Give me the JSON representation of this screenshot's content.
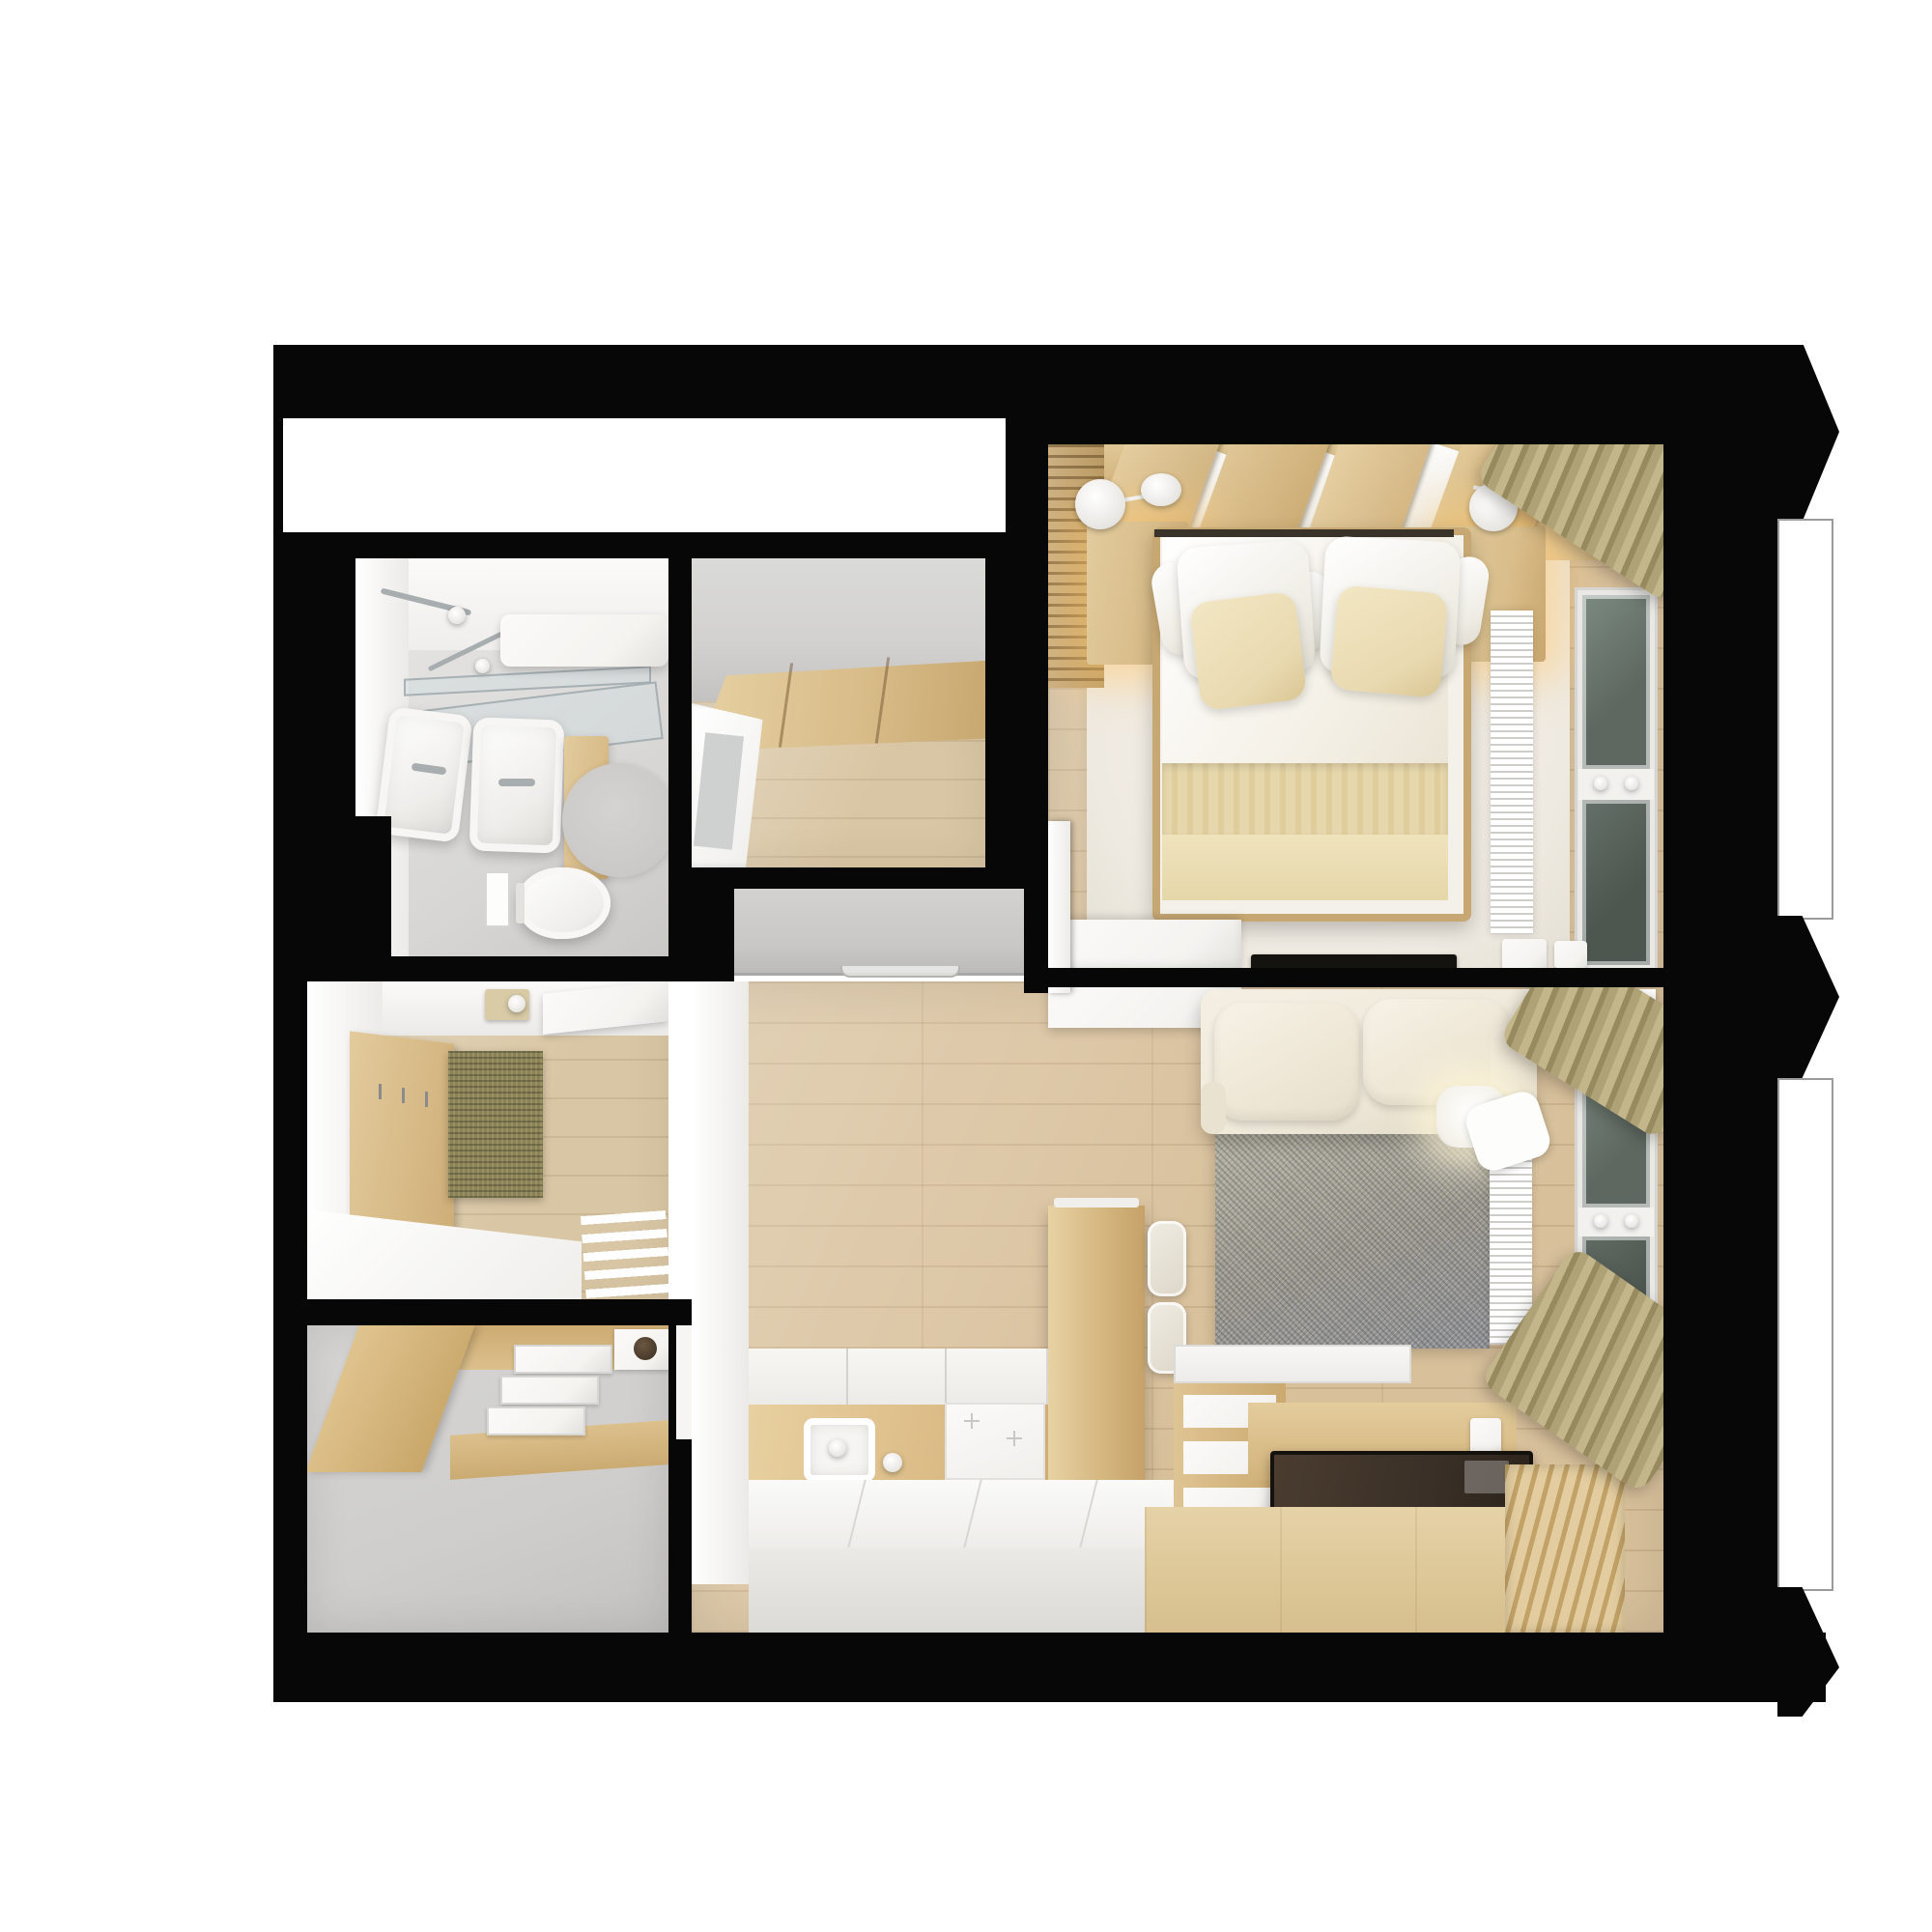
{
  "meta": {
    "title": "Top-down 3D render of a one-bedroom apartment floor plan",
    "view": "orthographic top view, black cut walls on white background",
    "visible_text": "none"
  },
  "palette": {
    "page": "#ffffff",
    "wall": "#070707",
    "floor": "#d8c09b",
    "floor2": "#d9c6a4",
    "panel": "#d9bd8a",
    "panelDark": "#c9a76e",
    "grayWall": "#d2d1cf",
    "grayFloor": "#cfcecc",
    "slab": "#c8c7c5",
    "whiteF": "#f4f3f0",
    "cream": "#efe9da",
    "beige": "#e9d9b0",
    "bedRug": "#efeae1",
    "rugA": "#9b988f",
    "rugB": "#b8b4a6",
    "glassA": "#5e6860",
    "glassB": "#4d574f",
    "frame": "#e9e8e4",
    "curtA": "#c3b68b",
    "curtB": "#978a5f",
    "mat": "#8a8254",
    "darkT": "#3a3027",
    "glow": "rgba(255,198,110,0.55)",
    "chrome": "#a8adb0"
  },
  "rooms": {
    "bathroom": {
      "label": "Bathroom",
      "items": [
        "shower set",
        "glass screen",
        "bathtub",
        "double washbasin",
        "vanity cabinet",
        "round rug",
        "wall-hung toilet",
        "flush plate"
      ]
    },
    "closet": {
      "label": "Walk-in closet",
      "items": [
        "wardrobe front",
        "white glazed door"
      ]
    },
    "bedroom": {
      "label": "Bedroom",
      "items": [
        "double bed",
        "white and beige pillows",
        "two nightstands with lit sconces",
        "slatted accent wall",
        "angled headboard panels",
        "area rug",
        "white dresser",
        "flat TV on wall shelf",
        "radiator grille",
        "window with dark sashes",
        "olive curtain"
      ]
    },
    "hallway": {
      "label": "Hallway",
      "items": [
        "gray wardrobe cabinet",
        "white bedroom door"
      ]
    },
    "entry": {
      "label": "Entry hall",
      "items": [
        "intercom panel",
        "coat panel with hooks",
        "olive doormat",
        "white shelf",
        "white console",
        "drying rack"
      ]
    },
    "storage": {
      "label": "Storage room",
      "items": [
        "wood cabinet",
        "white drawer boxes",
        "tray with dark bowl",
        "gray floor"
      ]
    },
    "living": {
      "label": "Living room with kitchen",
      "items": [
        "cream sofa",
        "glowing floor lamp",
        "speckled rug",
        "wood dining table",
        "two stools",
        "white kitchen counters",
        "sink",
        "induction hob",
        "storage platform with compartments",
        "dark low table",
        "slatted deck",
        "radiator grille",
        "window with dark sashes",
        "olive curtains"
      ]
    },
    "balcony": {
      "label": "Balcony outline with section arrows",
      "items": [
        "three right-pointing wall arrows",
        "thin outlined balcony strips"
      ]
    }
  }
}
